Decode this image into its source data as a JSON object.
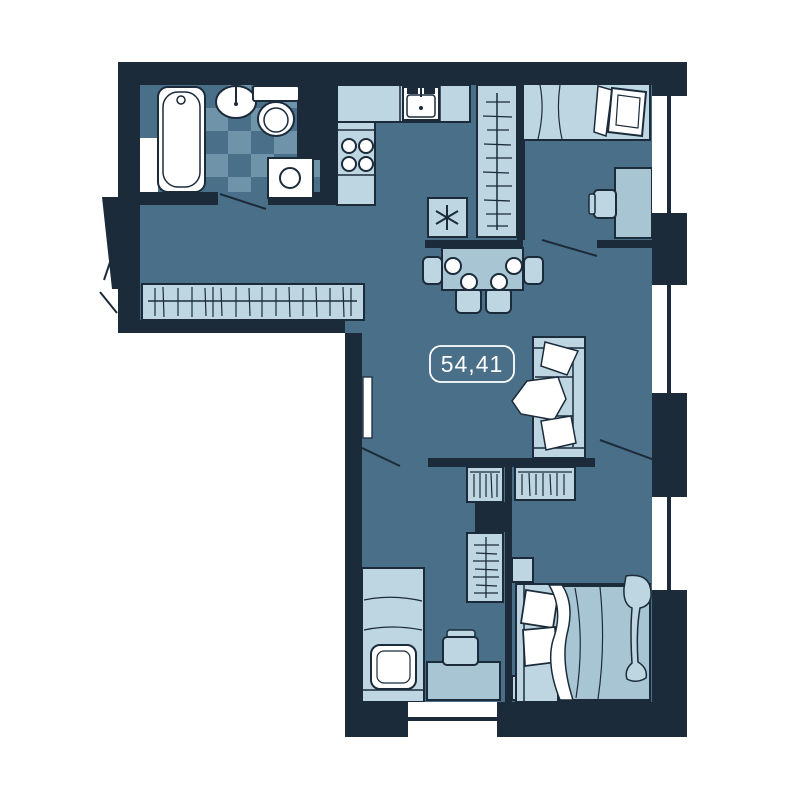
{
  "floorplan": {
    "area_label": "54,41",
    "colors": {
      "page_background": "#FFFFFF",
      "walls": "#1B2B3A",
      "floor": "#4A7089",
      "floor_tile_alt": "#6F94A9",
      "furniture_light": "#BED6E2",
      "furniture_medium": "#A8C5D4",
      "fixtures": "#FFFFFF"
    },
    "window_count": 4,
    "fixtures_and_furniture": [
      "bathtub",
      "washbasin",
      "toilet",
      "washing-machine",
      "kitchen-counter",
      "kitchen-sink",
      "stove",
      "refrigerator",
      "tall-wardrobe",
      "hall-wardrobe",
      "dining-table",
      "dining-chairs",
      "plates",
      "sofa",
      "single-bed",
      "double-bed",
      "desk",
      "desk-chair",
      "nightstand",
      "wardrobe",
      "curtain"
    ]
  }
}
